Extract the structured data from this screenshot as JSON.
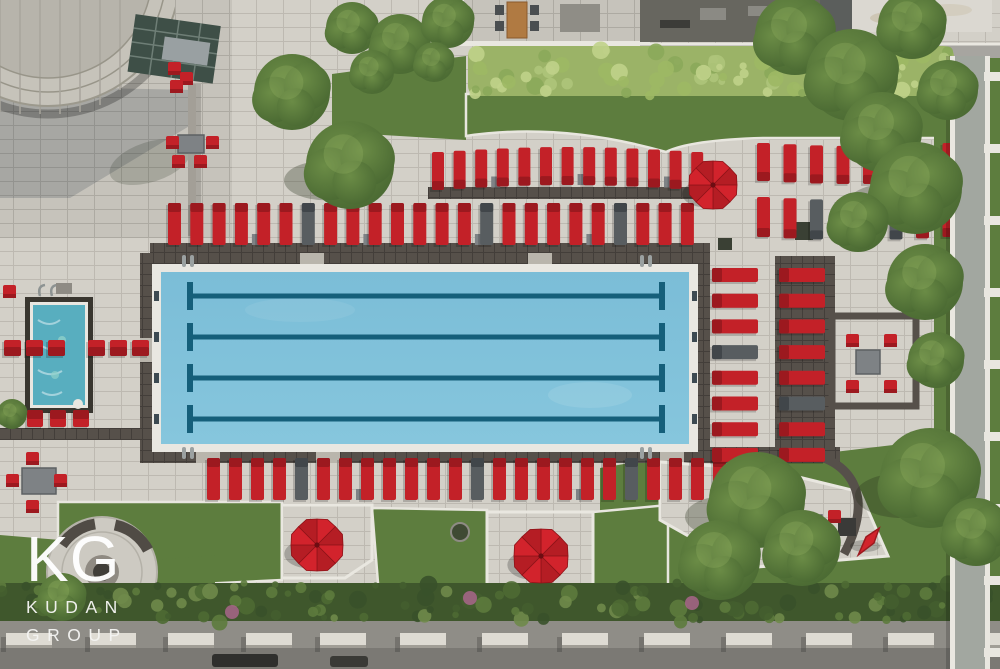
{
  "watermark": {
    "logo": "KG",
    "line1": "KUDAN",
    "line2": "GROUP"
  },
  "palette": {
    "paver": "#d3d0c8",
    "terrace": "#c6c3bb",
    "deckDark": "#56504a",
    "deckDark2": "#47423c",
    "coping": "#e9e7e1",
    "water": "#7bbdd7",
    "waterDeep": "#6fb3cf",
    "lane": "#155f7a",
    "spaWater": "#58aebf",
    "red": "#c32128",
    "redDark": "#9c191f",
    "umbrella": "#d2232c",
    "umbrellaDark": "#b51d24",
    "greyChair": "#585d60",
    "greyChairDark": "#41464a",
    "table": "#7e8285",
    "grass": "#5d7d3e",
    "grassLight": "#6f9048",
    "hedge": "#9bb367",
    "tree": "#486731",
    "treeLight": "#6b8c46",
    "shrub": "#3f572c",
    "street": "#8f8d87",
    "road": "#7b7974",
    "block": "#dedbd3",
    "blockSide": "#a19e96",
    "walk": "#a2a7a0",
    "white": "#e9e7e0",
    "wood": "#b07a42",
    "glassRoof": "#3e4f47",
    "darkRoof": "#67665f",
    "whiteRoof": "#dbd8d1",
    "shadow": "rgba(45,55,70,0.20)"
  },
  "scene": {
    "pool": {
      "lanes_y": [
        296,
        337,
        378,
        419
      ],
      "lane_x1": 190,
      "lane_x2": 662,
      "target_x": [
        154,
        692
      ],
      "ladders": [
        [
          182,
          255
        ],
        [
          182,
          447
        ],
        [
          640,
          255
        ],
        [
          640,
          447
        ]
      ]
    },
    "lounger_rows": [
      {
        "x": 432,
        "y": 152,
        "count": 13,
        "pitch": 21.6,
        "len": 38,
        "wid": 12,
        "orient": "v",
        "head": "bottom",
        "greys": [],
        "tables": [
          2,
          6,
          10
        ],
        "curve": -5
      },
      {
        "x": 757,
        "y": 143,
        "count": 8,
        "pitch": 26.5,
        "len": 38,
        "wid": 13,
        "orient": "v",
        "head": "bottom",
        "greys": [],
        "tables": [],
        "curve": 3
      },
      {
        "x": 757,
        "y": 197,
        "count": 8,
        "pitch": 26.5,
        "len": 40,
        "wid": 13,
        "orient": "v",
        "head": "bottom",
        "greys": [
          2,
          5
        ],
        "tables": [],
        "curve": 3
      },
      {
        "x": 168,
        "y": 203,
        "count": 24,
        "pitch": 22.3,
        "len": 42,
        "wid": 13,
        "orient": "v",
        "head": "top",
        "greys": [
          6,
          14,
          20
        ],
        "tables": [
          3,
          8,
          13,
          18
        ],
        "curve": 0
      },
      {
        "x": 207,
        "y": 458,
        "count": 25,
        "pitch": 22,
        "len": 42,
        "wid": 13,
        "orient": "v",
        "head": "top",
        "greys": [
          4,
          12,
          19
        ],
        "tables": [
          6,
          16
        ],
        "curve": 0
      },
      {
        "x": 712,
        "y": 268,
        "count": 8,
        "pitch": 25.7,
        "len": 46,
        "wid": 14,
        "orient": "h",
        "head": "left",
        "greys": [
          3
        ],
        "tables": [],
        "curve": 0
      },
      {
        "x": 779,
        "y": 268,
        "count": 8,
        "pitch": 25.7,
        "len": 46,
        "wid": 14,
        "orient": "h",
        "head": "left",
        "greys": [
          5
        ],
        "tables": [],
        "curve": 0
      },
      {
        "x": 4,
        "y": 340,
        "count": 3,
        "pitch": 22,
        "len": 16,
        "wid": 17,
        "orient": "v",
        "head": "bottom",
        "greys": [],
        "tables": [],
        "curve": 0
      },
      {
        "x": 88,
        "y": 340,
        "count": 3,
        "pitch": 22,
        "len": 16,
        "wid": 17,
        "orient": "v",
        "head": "bottom",
        "greys": [],
        "tables": [],
        "curve": 0
      },
      {
        "x": 27,
        "y": 410,
        "count": 3,
        "pitch": 23,
        "len": 17,
        "wid": 16,
        "orient": "o",
        "head": "top",
        "greys": [],
        "tables": [],
        "curve": 0
      }
    ],
    "umbrellas": [
      {
        "cx": 713,
        "cy": 185,
        "r": 24
      },
      {
        "cx": 317,
        "cy": 545,
        "r": 26
      },
      {
        "cx": 541,
        "cy": 556,
        "r": 27
      },
      {
        "cx": 870,
        "cy": 540,
        "r": 15,
        "folded": true,
        "rot": 38
      }
    ],
    "trees": [
      {
        "cx": 292,
        "cy": 92,
        "r": 38
      },
      {
        "cx": 350,
        "cy": 165,
        "r": 44,
        "sh": 1
      },
      {
        "cx": 352,
        "cy": 28,
        "r": 26
      },
      {
        "cx": 400,
        "cy": 44,
        "r": 30
      },
      {
        "cx": 448,
        "cy": 22,
        "r": 26
      },
      {
        "cx": 434,
        "cy": 62,
        "r": 20
      },
      {
        "cx": 372,
        "cy": 72,
        "r": 22
      },
      {
        "cx": 795,
        "cy": 35,
        "r": 40
      },
      {
        "cx": 852,
        "cy": 75,
        "r": 46
      },
      {
        "cx": 912,
        "cy": 25,
        "r": 34
      },
      {
        "cx": 948,
        "cy": 90,
        "r": 30
      },
      {
        "cx": 882,
        "cy": 132,
        "r": 40
      },
      {
        "cx": 916,
        "cy": 188,
        "r": 46,
        "sh": 1
      },
      {
        "cx": 858,
        "cy": 222,
        "r": 30
      },
      {
        "cx": 925,
        "cy": 282,
        "r": 38
      },
      {
        "cx": 936,
        "cy": 360,
        "r": 28
      },
      {
        "cx": 757,
        "cy": 500,
        "r": 48,
        "sh": 1
      },
      {
        "cx": 720,
        "cy": 560,
        "r": 40
      },
      {
        "cx": 802,
        "cy": 548,
        "r": 38
      },
      {
        "cx": 930,
        "cy": 478,
        "r": 50,
        "sh": 1
      },
      {
        "cx": 976,
        "cy": 532,
        "r": 34
      },
      {
        "cx": 62,
        "cy": 597,
        "r": 24
      },
      {
        "cx": 12,
        "cy": 414,
        "r": 15
      }
    ],
    "hedge": {
      "x": 468,
      "y": 46,
      "w": 486,
      "h": 50,
      "count": 95,
      "seed": 11,
      "colors": [
        "#aec47a",
        "#8ba85a",
        "#9db864",
        "#c0d28a"
      ]
    },
    "shrubs": {
      "x": 0,
      "y": 583,
      "w": 1000,
      "h": 40,
      "count": 120,
      "seed": 5,
      "colors": [
        "#4e6a33",
        "#5d7b3d",
        "#38512a",
        "#6f8a4a",
        "#445e2f"
      ],
      "pinks": [
        [
          232,
          612
        ],
        [
          470,
          598
        ],
        [
          692,
          603
        ]
      ]
    },
    "street_blocks": {
      "y": 633,
      "h": 15,
      "w": 46,
      "xs": [
        6,
        90,
        168,
        246,
        320,
        400,
        482,
        562,
        644,
        726,
        806,
        888,
        958
      ]
    },
    "red_chairs": [
      [
        26,
        452
      ],
      [
        6,
        474
      ],
      [
        54,
        474
      ],
      [
        26,
        500
      ],
      [
        166,
        136
      ],
      [
        206,
        136
      ],
      [
        172,
        155
      ],
      [
        194,
        155
      ],
      [
        846,
        334
      ],
      [
        884,
        334
      ],
      [
        846,
        380
      ],
      [
        884,
        380
      ],
      [
        790,
        512
      ],
      [
        828,
        510
      ],
      [
        806,
        534
      ],
      [
        168,
        62
      ],
      [
        180,
        72
      ],
      [
        170,
        80
      ],
      [
        3,
        285
      ]
    ],
    "grey_tables": [
      [
        22,
        468,
        34,
        26
      ],
      [
        178,
        135,
        26,
        18
      ],
      [
        856,
        350,
        24,
        24
      ],
      [
        800,
        515,
        22,
        16
      ],
      [
        308,
        536,
        16,
        13
      ]
    ]
  }
}
